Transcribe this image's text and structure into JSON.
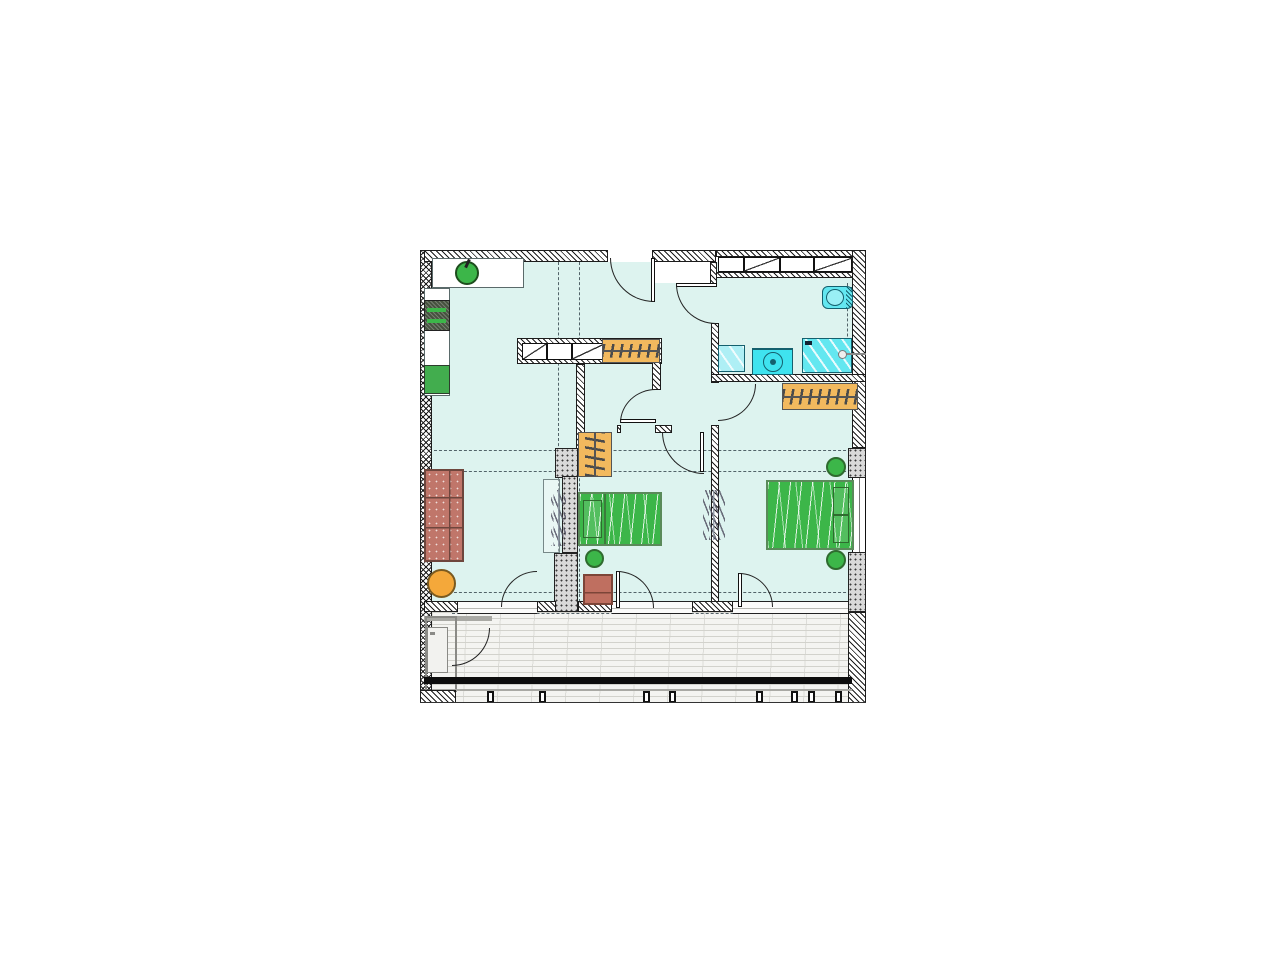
{
  "drawing": {
    "kind": "architectural-floor-plan",
    "visible_text": []
  },
  "palette": {
    "floor": "#ddf3ef",
    "columnFill": "#d9d9d9",
    "balconyFloor": "#f4f4f1",
    "balconyLine": "#d2d2cc",
    "railing": "#0d0d0d",
    "axis": "#3a4a52",
    "green": "#3cb649",
    "bedBorder": "#5a8a5a",
    "sofaRed": "#c0766a",
    "tableOrange": "#f4a83a",
    "wardrobeOrange": "#f2b95e",
    "wardrobeGlyph": "#4a4a4a",
    "cyanBright": "#3fe3ef",
    "cyanMid": "#63e7f0",
    "cyanLight": "#aeeff5"
  },
  "floorplan": {
    "rooms": [
      {
        "name": "kitchen-living-room"
      },
      {
        "name": "hallway"
      },
      {
        "name": "bathroom"
      },
      {
        "name": "bedroom-middle"
      },
      {
        "name": "bedroom-right"
      },
      {
        "name": "balcony"
      },
      {
        "name": "balcony-storage"
      }
    ],
    "items": [
      {
        "name": "kitchen-counter-top",
        "type": "counter",
        "x": 432,
        "y": 258,
        "w": 92,
        "h": 30
      },
      {
        "name": "kitchen-sink",
        "type": "sink-round",
        "x": 455,
        "y": 261,
        "w": 24,
        "h": 24
      },
      {
        "name": "kitchen-counter-left",
        "type": "counter",
        "x": 424,
        "y": 288,
        "w": 26,
        "h": 108
      },
      {
        "name": "kitchen-stove",
        "type": "stove",
        "x": 424,
        "y": 300,
        "w": 26,
        "h": 31
      },
      {
        "name": "kitchen-base-cabinet",
        "type": "cabinet-green",
        "x": 424,
        "y": 365,
        "w": 26,
        "h": 29
      },
      {
        "name": "sofa",
        "type": "sofa",
        "x": 424,
        "y": 469,
        "w": 40,
        "h": 93
      },
      {
        "name": "round-table",
        "type": "table-round",
        "x": 427,
        "y": 569,
        "w": 29,
        "h": 29
      },
      {
        "name": "wall-cabinet-outline",
        "type": "cabinet-outline",
        "x": 543,
        "y": 479,
        "w": 17,
        "h": 74
      },
      {
        "name": "coat-hooks-living",
        "type": "ticks-v",
        "x": 551,
        "y": 490,
        "w": 15,
        "h": 56
      },
      {
        "name": "wardrobe-partition",
        "type": "wardrobe-h",
        "x": 602,
        "y": 339,
        "w": 58,
        "h": 24
      },
      {
        "name": "wardrobe-hall",
        "type": "wardrobe-v",
        "x": 578,
        "y": 432,
        "w": 34,
        "h": 45
      },
      {
        "name": "wardrobe-bedroom-right",
        "type": "wardrobe-h",
        "x": 782,
        "y": 383,
        "w": 76,
        "h": 27
      },
      {
        "name": "bed-single",
        "type": "bed bed-single",
        "x": 578,
        "y": 492,
        "w": 84,
        "h": 54
      },
      {
        "name": "stool-middle-room",
        "type": "stool",
        "x": 585,
        "y": 549,
        "w": 19,
        "h": 19
      },
      {
        "name": "side-table",
        "type": "side-table",
        "x": 583,
        "y": 574,
        "w": 30,
        "h": 31
      },
      {
        "name": "bed-double",
        "type": "bed bed-double",
        "x": 766,
        "y": 480,
        "w": 88,
        "h": 70
      },
      {
        "name": "stool-right-top",
        "type": "stool",
        "x": 826,
        "y": 457,
        "w": 20,
        "h": 20
      },
      {
        "name": "stool-right-bottom",
        "type": "stool",
        "x": 826,
        "y": 550,
        "w": 20,
        "h": 20
      },
      {
        "name": "radiator-between-bedrooms",
        "type": "ticks-v",
        "x": 703,
        "y": 490,
        "w": 22,
        "h": 50
      },
      {
        "name": "toilet",
        "type": "toilet",
        "x": 822,
        "y": 286,
        "w": 31,
        "h": 23
      },
      {
        "name": "bathroom-sink",
        "type": "sink-square",
        "x": 718,
        "y": 345,
        "w": 27,
        "h": 27
      },
      {
        "name": "washing-machine",
        "type": "washer",
        "x": 752,
        "y": 348,
        "w": 41,
        "h": 27
      },
      {
        "name": "shower",
        "type": "shower",
        "x": 802,
        "y": 338,
        "w": 50,
        "h": 35
      },
      {
        "name": "shower-grab-bar",
        "type": "grab-bar",
        "x": 838,
        "y": 350,
        "w": 28,
        "h": 9
      },
      {
        "name": "storage-cabinet",
        "type": "cabinet-gray",
        "x": 427,
        "y": 627,
        "w": 21,
        "h": 46
      }
    ]
  }
}
